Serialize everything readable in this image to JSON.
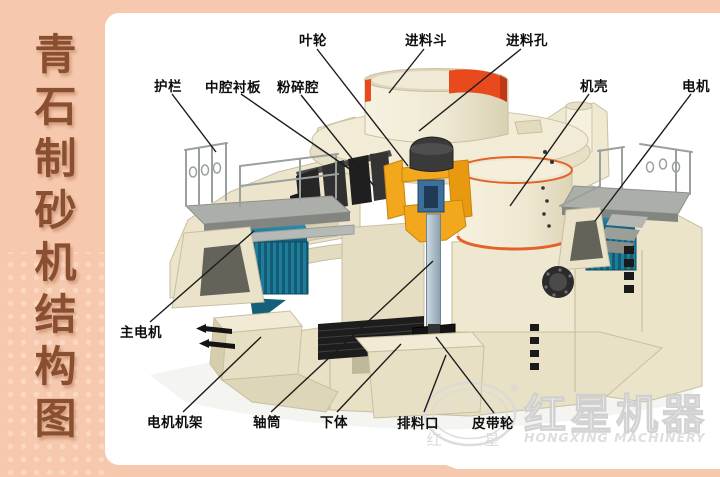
{
  "page": {
    "bg": "#f6c9ae",
    "panel_bg": "#ffffff"
  },
  "sidebar": {
    "title": "青石制砂机结构图",
    "text_color": "#8a4f30"
  },
  "labels": [
    {
      "id": "yelun",
      "text": "叶轮"
    },
    {
      "id": "jinliaodou",
      "text": "进料斗"
    },
    {
      "id": "jinliaokong",
      "text": "进料孔"
    },
    {
      "id": "hulan",
      "text": "护栏"
    },
    {
      "id": "zhongqiang-chenban",
      "text": "中腔衬板"
    },
    {
      "id": "fensuiqiang",
      "text": "粉碎腔"
    },
    {
      "id": "jike",
      "text": "机壳"
    },
    {
      "id": "dianji",
      "text": "电机"
    },
    {
      "id": "zhudianji",
      "text": "主电机"
    },
    {
      "id": "dianjijijia",
      "text": "电机机架"
    },
    {
      "id": "zhoutong",
      "text": "轴筒"
    },
    {
      "id": "xiati",
      "text": "下体"
    },
    {
      "id": "pailiaokou",
      "text": "排料口"
    },
    {
      "id": "pidailun",
      "text": "皮带轮"
    }
  ],
  "watermark": {
    "brand_zh": "红星机器",
    "brand_en": "HONGXING MACHINERY",
    "seal_left": "红",
    "seal_right": "星",
    "registered": "®",
    "stars": [
      "☆",
      "☆",
      "☆"
    ]
  },
  "colors": {
    "accent_red": "#e84a1e",
    "rim_orange": "#e2622a",
    "impeller_yellow": "#f2a71c",
    "motor_teal": "#176884",
    "cream": "#ece5cb",
    "salmon": "#f6c9ae",
    "title_brown": "#8a4f30"
  }
}
